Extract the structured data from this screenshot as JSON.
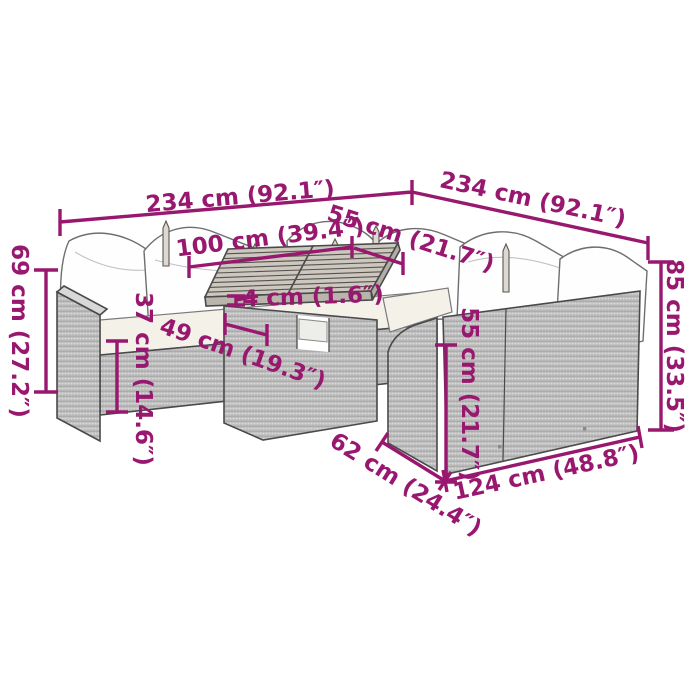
{
  "diagram": {
    "kind": "furniture-dimension-diagram",
    "subject": "garden corner sofa set with table",
    "accent_color": "#98186F",
    "labels": {
      "width_left": "234 cm (92.1″)",
      "width_right": "234 cm (92.1″)",
      "table_width": "100 cm (39.4″)",
      "corner_seat_width": "55 cm (21.7″)",
      "tabletop_thickness": "4 cm (1.6″)",
      "back_height": "69 cm (27.2″)",
      "base_height": "37 cm (14.6″)",
      "table_depth": "49 cm (19.3″)",
      "seat_back_height": "55 cm (21.7″)",
      "total_height": "85 cm (33.5″)",
      "sofa_depth": "62 cm (24.4″)",
      "sofa_width": "124 cm (48.8″)"
    }
  }
}
